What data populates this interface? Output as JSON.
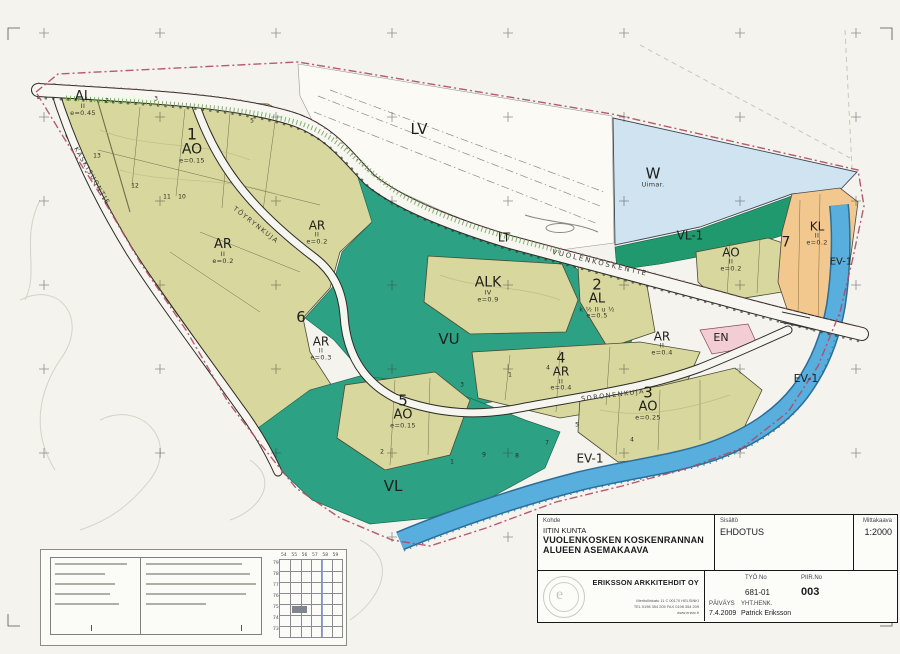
{
  "map": {
    "zones": [
      {
        "label": "AL",
        "x": 83,
        "y": 104,
        "size": 13,
        "subs": [
          "II",
          "e=0.45"
        ]
      },
      {
        "n": "1",
        "label": "AO",
        "x": 192,
        "y": 146,
        "size": 14,
        "subs": [
          "e=0.15"
        ]
      },
      {
        "label": "AR",
        "x": 223,
        "y": 252,
        "size": 13,
        "subs": [
          "II",
          "e=0.2"
        ]
      },
      {
        "label": "AR",
        "x": 317,
        "y": 233,
        "size": 12,
        "subs": [
          "II",
          "e=0.2"
        ]
      },
      {
        "label": "6",
        "x": 301,
        "y": 318,
        "size": 15,
        "subs": []
      },
      {
        "label": "AR",
        "x": 321,
        "y": 349,
        "size": 12,
        "subs": [
          "II",
          "e=0.3"
        ]
      },
      {
        "label": "ALK",
        "x": 488,
        "y": 290,
        "size": 14,
        "subs": [
          "IV",
          "e=0.9"
        ]
      },
      {
        "n": "2",
        "label": "AL",
        "x": 597,
        "y": 299,
        "size": 13,
        "subs": [
          "k ½ II u ½",
          "e=0.5"
        ]
      },
      {
        "label": "VU",
        "x": 449,
        "y": 340,
        "size": 15,
        "subs": []
      },
      {
        "n": "4",
        "label": "AR",
        "x": 561,
        "y": 372,
        "size": 12,
        "subs": [
          "II",
          "e=0.4"
        ]
      },
      {
        "label": "AR",
        "x": 662,
        "y": 344,
        "size": 12,
        "subs": [
          "II",
          "e=0.4"
        ]
      },
      {
        "n": "5",
        "label": "AO",
        "x": 403,
        "y": 412,
        "size": 13,
        "subs": [
          "e=0.15"
        ]
      },
      {
        "n": "3",
        "label": "AO",
        "x": 648,
        "y": 404,
        "size": 13,
        "subs": [
          "e=0.25"
        ]
      },
      {
        "label": "VL",
        "x": 393,
        "y": 487,
        "size": 15,
        "subs": []
      },
      {
        "label": "EV-1",
        "x": 590,
        "y": 459,
        "size": 12,
        "subs": []
      },
      {
        "label": "EV-1",
        "x": 806,
        "y": 379,
        "size": 11,
        "subs": []
      },
      {
        "label": "EV-1",
        "x": 841,
        "y": 263,
        "size": 10,
        "subs": []
      },
      {
        "label": "W",
        "x": 653,
        "y": 178,
        "size": 15,
        "subs": [
          "Uimar."
        ]
      },
      {
        "label": "VL-1",
        "x": 690,
        "y": 236,
        "size": 12,
        "subs": []
      },
      {
        "label": "AO",
        "x": 731,
        "y": 260,
        "size": 12,
        "subs": [
          "II",
          "e=0.2"
        ]
      },
      {
        "label": "7",
        "x": 786,
        "y": 243,
        "size": 14,
        "subs": []
      },
      {
        "label": "KL",
        "x": 817,
        "y": 234,
        "size": 12,
        "subs": [
          "II",
          "e=0.2"
        ]
      },
      {
        "label": "EN",
        "x": 721,
        "y": 338,
        "size": 11,
        "subs": []
      },
      {
        "label": "LV",
        "x": 419,
        "y": 130,
        "size": 15,
        "subs": []
      },
      {
        "label": "LT",
        "x": 504,
        "y": 238,
        "size": 12,
        "subs": []
      }
    ],
    "roads": [
      {
        "name": "VUOLENKOSKENTIE",
        "x": 600,
        "y": 263,
        "rot": 13,
        "size": 7,
        "ls": 2
      },
      {
        "name": "TÖYRYNKUJA",
        "x": 256,
        "y": 225,
        "rot": 38,
        "size": 6.5,
        "ls": 1.5
      },
      {
        "name": "SORONENKUJA",
        "x": 613,
        "y": 395,
        "rot": -7,
        "size": 6.5,
        "ls": 1.5
      },
      {
        "name": "KASKISUONTIE",
        "x": 92,
        "y": 176,
        "rot": 60,
        "size": 6.5,
        "ls": 1.5
      }
    ],
    "lot_numbers": [
      {
        "t": "2",
        "x": 107,
        "y": 101
      },
      {
        "t": "3",
        "x": 156,
        "y": 99
      },
      {
        "t": "5",
        "x": 252,
        "y": 121
      },
      {
        "t": "13",
        "x": 97,
        "y": 156
      },
      {
        "t": "12",
        "x": 135,
        "y": 186
      },
      {
        "t": "11",
        "x": 167,
        "y": 197
      },
      {
        "t": "10",
        "x": 182,
        "y": 197
      },
      {
        "t": "2",
        "x": 382,
        "y": 452
      },
      {
        "t": "1",
        "x": 452,
        "y": 462
      },
      {
        "t": "9",
        "x": 484,
        "y": 455
      },
      {
        "t": "8",
        "x": 517,
        "y": 456
      },
      {
        "t": "7",
        "x": 547,
        "y": 443
      },
      {
        "t": "4",
        "x": 548,
        "y": 368
      },
      {
        "t": "3",
        "x": 462,
        "y": 385
      },
      {
        "t": "1",
        "x": 510,
        "y": 375
      },
      {
        "t": "5",
        "x": 577,
        "y": 425
      },
      {
        "t": "4",
        "x": 632,
        "y": 440
      }
    ],
    "colors": {
      "olive": "#d8d79d",
      "green": "#2da183",
      "green_dark": "#21996f",
      "water": "#cfe3f1",
      "river": "#58aedd",
      "orange": "#f3c88e",
      "pink": "#f2cdd3",
      "boundary_red": "#b04a60",
      "paper": "#f4f3ee"
    }
  },
  "legend": {
    "index_grid": {
      "cols": [
        "54",
        "55",
        "56",
        "57",
        "58",
        "59"
      ],
      "rows": [
        "79",
        "78",
        "77",
        "76",
        "75",
        "74",
        "73"
      ]
    }
  },
  "title_block": {
    "kohde_label": "Kohde",
    "municipality": "IITIN KUNTA",
    "title_line1": "VUOLENKOSKEN KOSKENRANNAN",
    "title_line2": "ALUEEN ASEMAKAAVA",
    "sisalto_label": "Sisältö",
    "sisalto_value": "EHDOTUS",
    "scale_label": "Mittakaava",
    "scale_value": "1:2000",
    "firm_name": "ERIKSSON ARKKITEHDIT OY",
    "firm_address_line1": "Meritullinkatu 11 C  00170 HELSINKI",
    "firm_address_line2": "TEL 0198 354 205   FAX 0198 354 209",
    "firm_address_line3": "www.eriarc.fi",
    "tyo_no_label": "TYÖ No",
    "tyo_no_value": "681-01",
    "piir_no_label": "PIIR.No",
    "piir_no_value": "003",
    "date_label": "PÄIVÄYS",
    "date_value": "7.4.2009",
    "contact_label": "YHT.HENK.",
    "contact_value": "Patrick Eriksson"
  }
}
